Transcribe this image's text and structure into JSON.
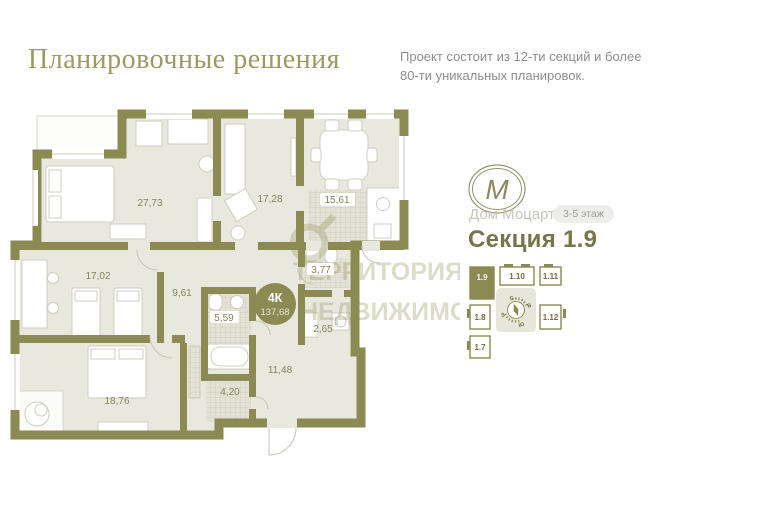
{
  "header": {
    "title": "Планировочные решения",
    "subtitle": [
      "Проект состоит из 12-ти секций и более",
      "80-ти уникальных планировок."
    ]
  },
  "plan": {
    "badge": {
      "type": "4К",
      "total_area": "137,68"
    },
    "rooms": [
      {
        "area": "27,73"
      },
      {
        "area": "17,28"
      },
      {
        "area": "15,61"
      },
      {
        "area": "17,02"
      },
      {
        "area": "9,61"
      },
      {
        "area": "5,59"
      },
      {
        "area": "3,77"
      },
      {
        "area": "2,65"
      },
      {
        "area": "11,48"
      },
      {
        "area": "4,20"
      },
      {
        "area": "18,76"
      }
    ],
    "watermark": [
      "ТЕРРИТОРИЯ",
      "НЕДВИЖИМОСТИ"
    ]
  },
  "sidebar": {
    "logo_monogram": "M",
    "project_name": "Дом Моцарт",
    "floors_badge": "3-5 этаж",
    "section_title": "Секция 1.9",
    "minimap": {
      "selected_unit": "1.9",
      "units": [
        "1.9",
        "1.10",
        "1.11",
        "1.8",
        "1.12",
        "1.7"
      ],
      "compass": {
        "n": "С",
        "e": "В",
        "s": "Ю",
        "w": "З"
      }
    }
  },
  "colors": {
    "wall": "#8a8a52",
    "floor": "#e9e8de",
    "accent": "#76764a",
    "muted": "#8e8e8e",
    "light_text": "#c8c5b9"
  }
}
